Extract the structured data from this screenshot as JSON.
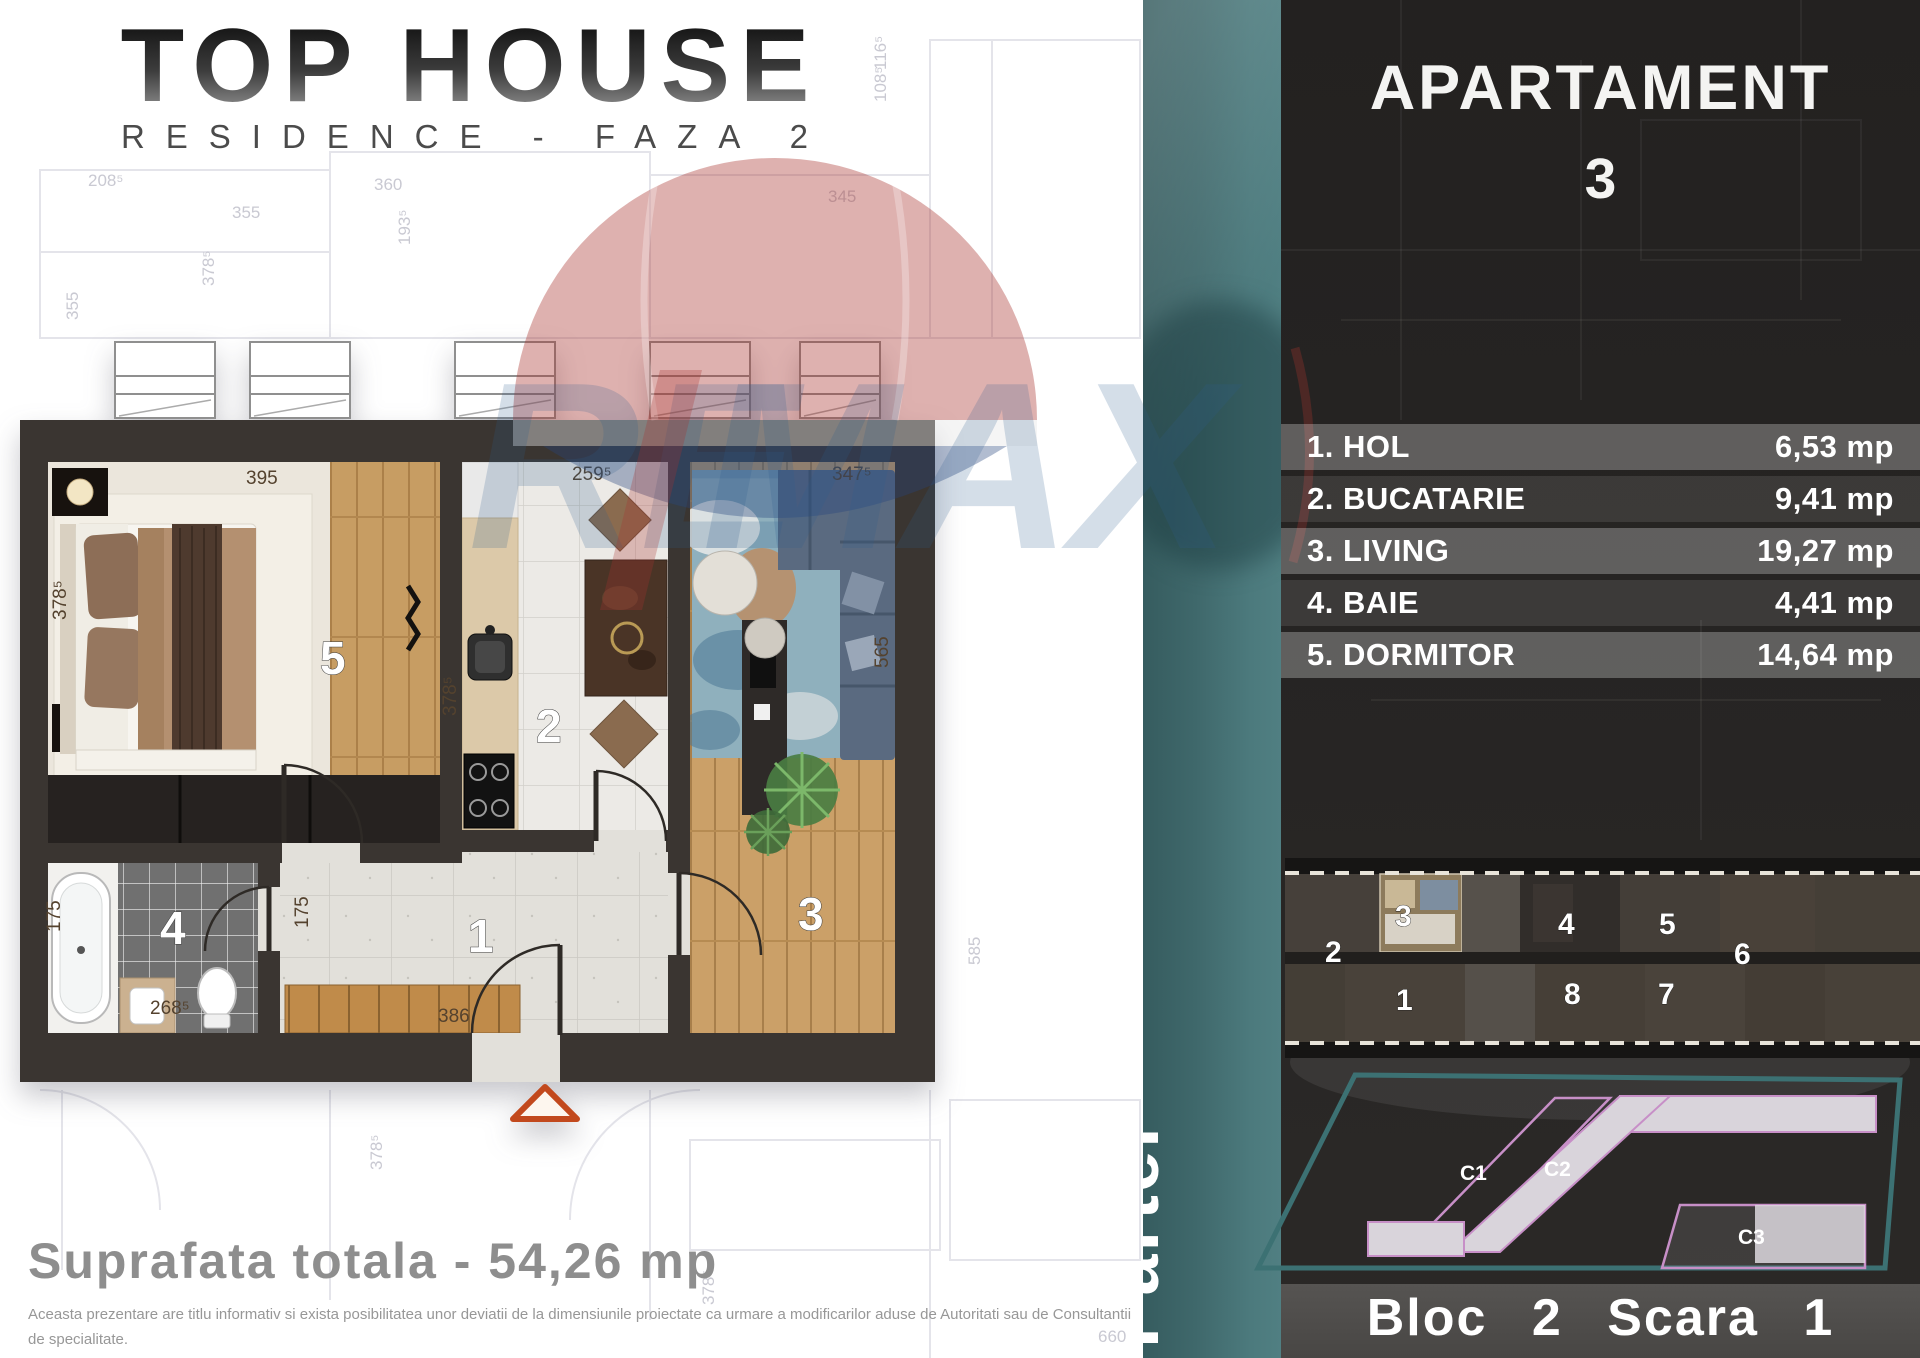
{
  "logo": {
    "title": "TOP HOUSE",
    "subtitle": "RESIDENCE - FAZA 2"
  },
  "plan": {
    "total": "Suprafata totala - 54,26 mp",
    "disclaimer1": "Aceasta prezentare are titlu informativ si exista posibilitatea unor deviatii de la dimensiunile proiectate ca urmare a modificarilor aduse de Autoritati sau de Consultantii de specialitate.",
    "disclaimer2": "Echipamentele si mobilierul care apar in acest plan au strict functia de a ilustra posibilitatea apartamentului si nu fac parte din cee ce se va preda.",
    "rooms": {
      "hall": "1",
      "kitchen": "2",
      "living": "3",
      "bath": "4",
      "bedroom": "5"
    },
    "dims": {
      "bedroom_top": "395",
      "kitchen_top": "259⁵",
      "living_top": "347⁵",
      "bedroom_left": "378⁵",
      "kitchen_side": "378⁵",
      "bath_side": "175",
      "hall_side": "175",
      "bath_bottom": "268⁵",
      "hall_bottom": "386",
      "living_right": "565"
    }
  },
  "backdrop": {
    "labels": [
      "208⁵",
      "355",
      "360",
      "345",
      "193⁵",
      "378⁵",
      "355",
      "116⁵",
      "108⁵",
      "585",
      "378⁵",
      "378⁵",
      "660"
    ]
  },
  "watermark": {
    "letters_left": "RE",
    "letters_right": "MAX",
    "balloon_red": "#a9322d",
    "balloon_blue": "#27457e"
  },
  "sidebar": {
    "floor": "Parter"
  },
  "panel": {
    "title": "APARTAMENT",
    "number": "3",
    "rooms": [
      {
        "name": "1. HOL",
        "area": "6,53 mp"
      },
      {
        "name": "2. BUCATARIE",
        "area": "9,41 mp"
      },
      {
        "name": "3. LIVING",
        "area": "19,27 mp"
      },
      {
        "name": "4. BAIE",
        "area": "4,41 mp"
      },
      {
        "name": "5. DORMITOR",
        "area": "14,64 mp"
      }
    ],
    "overview": {
      "top": [
        "2",
        "3",
        "4",
        "5",
        "6"
      ],
      "bottom": [
        "1",
        "8",
        "7"
      ],
      "highlighted_unit": "3"
    },
    "site": {
      "buildings": [
        "C1",
        "C2",
        "C3"
      ]
    },
    "footer": "Bloc 2 Scara 1"
  },
  "colors": {
    "accent_teal": "#41696c",
    "panel_bg": "#242220",
    "wall": "#3a3531",
    "entrance_marker": "#c2491d",
    "site_outline": "#3c7173",
    "building_outline": "#c78fc7"
  }
}
